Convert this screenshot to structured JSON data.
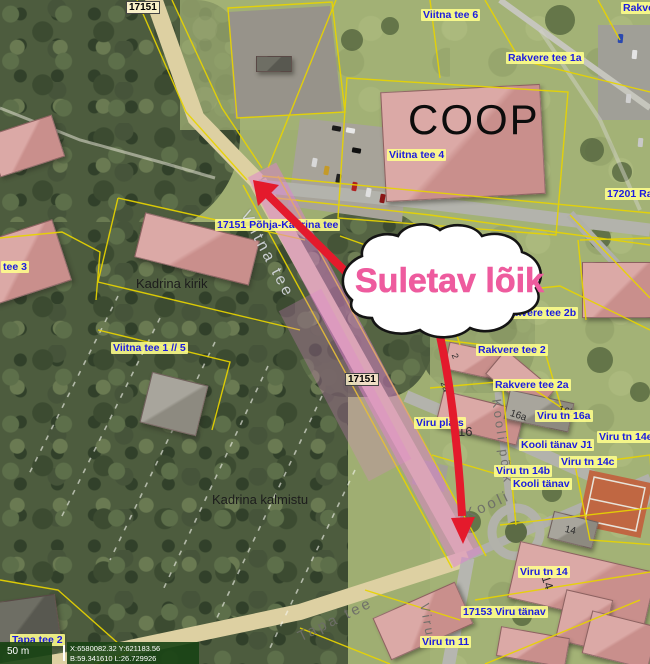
{
  "annotation": {
    "closure_label": "Suletav lõik",
    "closure_text_color": "#ee5b9e",
    "arrow_color": "#e41a2c",
    "road_highlight_color": "#e080d0"
  },
  "parcel_labels": [
    {
      "text": "Viitna tee 6"
    },
    {
      "text": "Rakvere tee 1a"
    },
    {
      "text": "Rakvere"
    },
    {
      "text": "Viitna tee 4"
    },
    {
      "text": "17201 Rakvere"
    },
    {
      "text": "17151 Põhja-Kadrina tee"
    },
    {
      "text": "Rakvere tee 2b"
    },
    {
      "text": "Rakvere tee 2"
    },
    {
      "text": "Rakvere tee 2a"
    },
    {
      "text": "Viru tn 16a"
    },
    {
      "text": "Viru plats"
    },
    {
      "text": "Kooli tänav J1"
    },
    {
      "text": "Viru tn 14b"
    },
    {
      "text": "Kooli tänav"
    },
    {
      "text": "Viru tn 14c"
    },
    {
      "text": "Viru tn 14e"
    },
    {
      "text": "Viru tn 14"
    },
    {
      "text": "17153 Viru tänav"
    },
    {
      "text": "Viru tn 11"
    },
    {
      "text": "Tapa tee 2"
    },
    {
      "text": "tee 3"
    },
    {
      "text": "Viitna tee 1 // 5"
    }
  ],
  "place_labels": {
    "church": "Kadrina kirik",
    "cemetery": "Kadrina kalmistu",
    "coop": "COOP"
  },
  "road_badges": [
    {
      "text": "17151"
    },
    {
      "text": "17151"
    }
  ],
  "street_names": [
    {
      "text": "Viitna tee"
    },
    {
      "text": "Kooli põik"
    },
    {
      "text": "Kooli"
    },
    {
      "text": "Tapa tee"
    },
    {
      "text": "Viru"
    }
  ],
  "building_numbers": [
    {
      "text": "16"
    },
    {
      "text": "16a"
    },
    {
      "text": "16b"
    },
    {
      "text": "14"
    },
    {
      "text": "14"
    },
    {
      "text": "2"
    },
    {
      "text": "2a"
    }
  ],
  "statusbar": {
    "scale": "50 m",
    "coords_line1": "X:6580082.32 Y:621183.56",
    "coords_line2": "B:59.341610 L:26.729926"
  }
}
